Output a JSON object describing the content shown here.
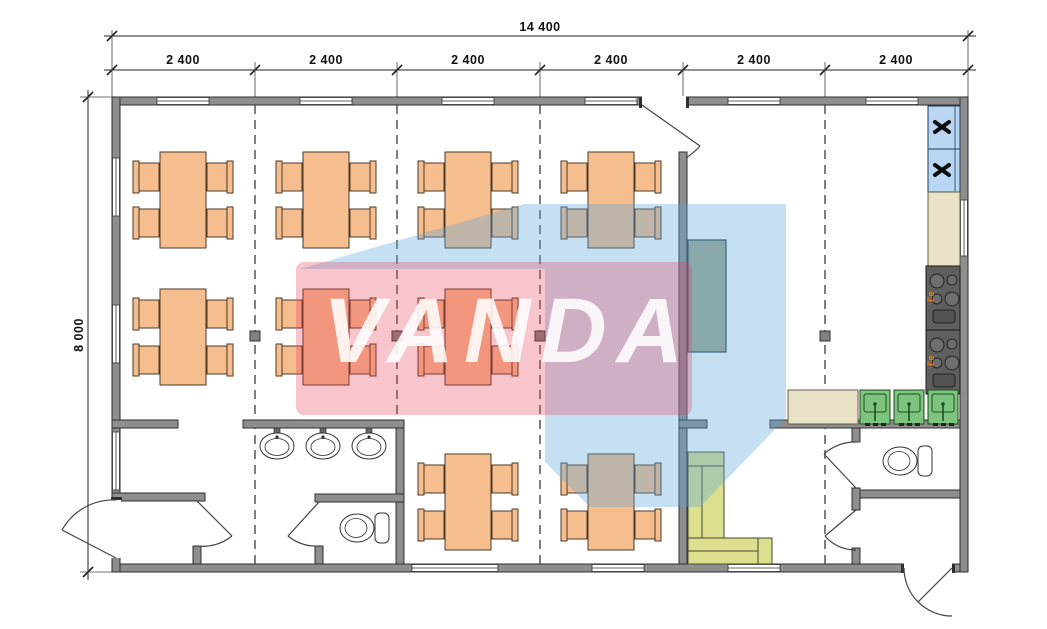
{
  "drawing": {
    "type": "floor-plan",
    "building": "modular cafe / canteen, 6 modules"
  },
  "dimensions": {
    "top_total": "14 400",
    "top_modules": [
      "2 400",
      "2 400",
      "2 400",
      "2 400",
      "2 400",
      "2 400"
    ],
    "left_height": "8 000"
  },
  "watermark": {
    "text": "VANDA",
    "pink_color": "rgba(233,62,91,0.30)",
    "blue_color": "rgba(90,165,220,0.35)"
  },
  "kitchen": {
    "stove_label": "Fe",
    "fridge_icon": "fan-cross-icon"
  },
  "colors": {
    "wall": "#8e8e8e",
    "table": "#f6bd8e",
    "sofa": "#dbdf8e",
    "sink": "#7dc57e",
    "fridge": "#b9d7f2",
    "counter": "#e9e2c6",
    "stove": "#5f5f5f",
    "cabinet": "#a3ab91"
  }
}
